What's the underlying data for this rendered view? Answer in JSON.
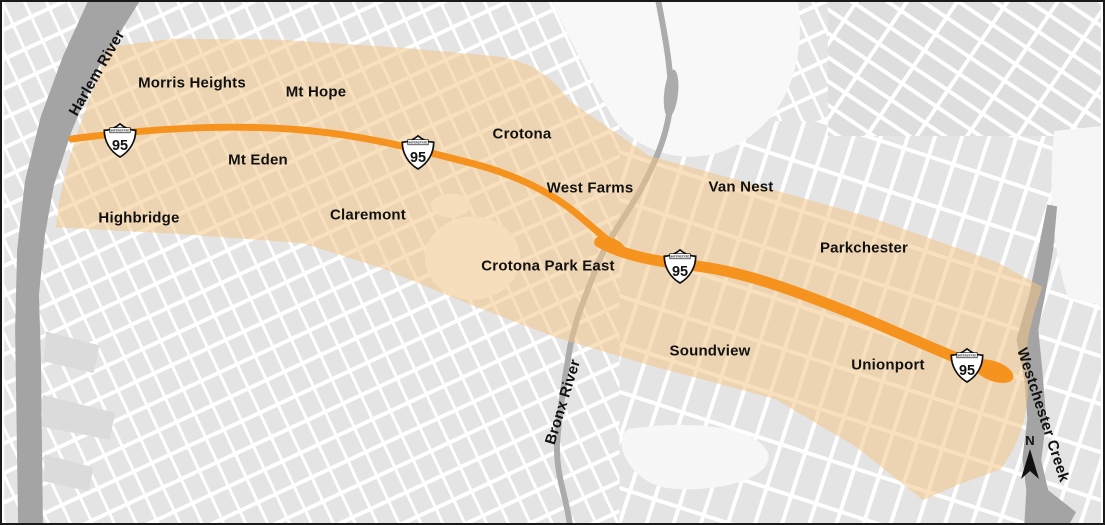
{
  "map": {
    "colors": {
      "background": "#FFFFFF",
      "block": "#E4E4E4",
      "block_alt": "#DEDEDE",
      "water": "#A4A4A4",
      "water_line": "#ACACAC",
      "corridor": "#F3C689",
      "corridor_opacity": "0.55",
      "highway": "#F6921E",
      "label": "#111111",
      "border": "#1A1A1A",
      "shield_fill": "#FFFFFF",
      "shield_stroke": "#111111"
    },
    "neighborhoods": [
      {
        "label": "Morris Heights",
        "x": 190,
        "y": 81
      },
      {
        "label": "Mt Hope",
        "x": 314,
        "y": 90
      },
      {
        "label": "Crotona",
        "x": 520,
        "y": 132
      },
      {
        "label": "Mt Eden",
        "x": 256,
        "y": 158
      },
      {
        "label": "West Farms",
        "x": 588,
        "y": 186
      },
      {
        "label": "Van Nest",
        "x": 739,
        "y": 185
      },
      {
        "label": "Highbridge",
        "x": 137,
        "y": 216
      },
      {
        "label": "Claremont",
        "x": 366,
        "y": 213
      },
      {
        "label": "Crotona Park East",
        "x": 546,
        "y": 264
      },
      {
        "label": "Parkchester",
        "x": 862,
        "y": 246
      },
      {
        "label": "Soundview",
        "x": 708,
        "y": 349
      },
      {
        "label": "Unionport",
        "x": 886,
        "y": 363
      }
    ],
    "waterways": [
      {
        "label": "Harlem River",
        "x": 95,
        "y": 71,
        "angle": -60
      },
      {
        "label": "Bronx River",
        "x": 561,
        "y": 400,
        "angle": -73
      },
      {
        "label": "Westchester Creek",
        "x": 1041,
        "y": 413,
        "angle": 72
      }
    ],
    "highway_shields": [
      {
        "banner": "INTERSTATE",
        "number": "95",
        "x": 118,
        "y": 138
      },
      {
        "banner": "INTERSTATE",
        "number": "95",
        "x": 416,
        "y": 150
      },
      {
        "banner": "INTERSTATE",
        "number": "95",
        "x": 678,
        "y": 264
      },
      {
        "banner": "INTERSTATE",
        "number": "95",
        "x": 965,
        "y": 363
      }
    ],
    "north_arrow": {
      "label": "N",
      "x": 1028,
      "y": 455
    }
  }
}
